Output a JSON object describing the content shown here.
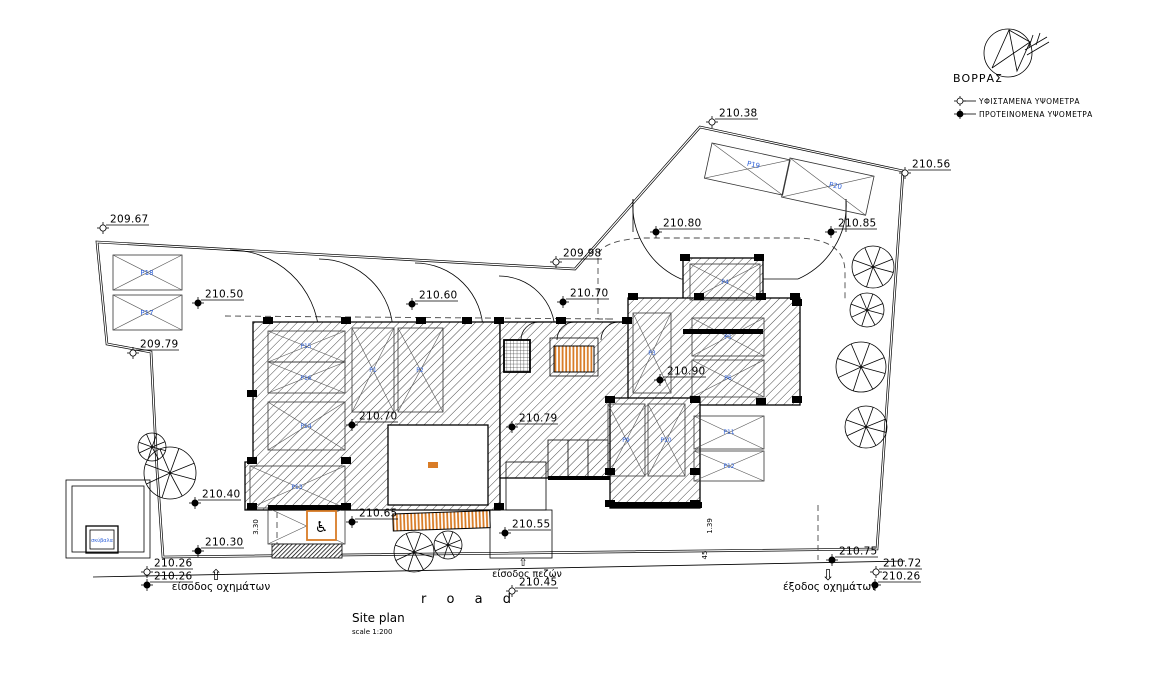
{
  "drawing": {
    "title": "Site plan",
    "scale": "scale 1:200",
    "road_label": "r o a d",
    "compass_label": "ΒΟΡΡΑΣ",
    "legend": {
      "existing_label": "ΥΦΙΣΤΑΜΕΝΑ ΥΨΟΜΕΤΡΑ",
      "proposed_label": "ΠΡΟΤΕΙΝΟΜΕΝΑ ΥΨΟΜΕΤΡΑ"
    },
    "entrances": {
      "vehicle_entrance": "είσοδος οχημάτων",
      "pedestrian_entrance": "είσοδος πεζών",
      "vehicle_exit": "έξοδος οχημάτων"
    },
    "waste_box_label": "σκύβαλα",
    "accessible_parking_symbol": "♿",
    "arrows": {
      "up": "⇧",
      "down": "⇩"
    },
    "elevation_markers": [
      {
        "value": "209.67",
        "type": "existing",
        "x": 103,
        "y": 228
      },
      {
        "value": "210.38",
        "type": "existing",
        "x": 712,
        "y": 122
      },
      {
        "value": "210.56",
        "type": "existing",
        "x": 905,
        "y": 173
      },
      {
        "value": "209.98",
        "type": "existing",
        "x": 556,
        "y": 262
      },
      {
        "value": "209.79",
        "type": "existing",
        "x": 133,
        "y": 353
      },
      {
        "value": "210.50",
        "type": "proposed",
        "x": 198,
        "y": 303
      },
      {
        "value": "210.60",
        "type": "proposed",
        "x": 412,
        "y": 304
      },
      {
        "value": "210.70",
        "type": "proposed",
        "x": 563,
        "y": 302
      },
      {
        "value": "210.80",
        "type": "proposed",
        "x": 656,
        "y": 232
      },
      {
        "value": "210.85",
        "type": "proposed",
        "x": 831,
        "y": 232
      },
      {
        "value": "210.70",
        "type": "proposed",
        "x": 352,
        "y": 425
      },
      {
        "value": "210.79",
        "type": "proposed",
        "x": 512,
        "y": 427
      },
      {
        "value": "210.90",
        "type": "proposed",
        "x": 660,
        "y": 380
      },
      {
        "value": "210.40",
        "type": "proposed",
        "x": 195,
        "y": 503
      },
      {
        "value": "210.65",
        "type": "proposed",
        "x": 352,
        "y": 522
      },
      {
        "value": "210.55",
        "type": "proposed",
        "x": 505,
        "y": 533
      },
      {
        "value": "210.30",
        "type": "proposed",
        "x": 198,
        "y": 551
      },
      {
        "value": "210.26",
        "type": "existing",
        "x": 147,
        "y": 572
      },
      {
        "value": "210.26",
        "type": "proposed",
        "x": 147,
        "y": 585
      },
      {
        "value": "210.45",
        "type": "existing",
        "x": 512,
        "y": 591
      },
      {
        "value": "210.75",
        "type": "proposed",
        "x": 832,
        "y": 560
      },
      {
        "value": "210.72",
        "type": "existing",
        "x": 876,
        "y": 572
      },
      {
        "value": "210.26",
        "type": "proposed",
        "x": 875,
        "y": 585
      }
    ],
    "parking_labels": [
      {
        "label": "P18",
        "x": 147,
        "y": 275,
        "size": 7,
        "rot": 0
      },
      {
        "label": "P17",
        "x": 147,
        "y": 315,
        "size": 7,
        "rot": 0
      },
      {
        "label": "P19",
        "x": 753,
        "y": 167,
        "size": 7,
        "rot": 12
      },
      {
        "label": "P20",
        "x": 835,
        "y": 188,
        "size": 7,
        "rot": 12
      },
      {
        "label": "P15",
        "x": 306,
        "y": 348,
        "size": 6,
        "rot": 0
      },
      {
        "label": "P16",
        "x": 306,
        "y": 380,
        "size": 6,
        "rot": 0
      },
      {
        "label": "P14",
        "x": 306,
        "y": 428,
        "size": 6,
        "rot": 0
      },
      {
        "label": "P13",
        "x": 297,
        "y": 489,
        "size": 6,
        "rot": 0
      },
      {
        "label": "P1",
        "x": 373,
        "y": 372,
        "size": 6,
        "rot": 0
      },
      {
        "label": "P2",
        "x": 420,
        "y": 372,
        "size": 6,
        "rot": 0
      },
      {
        "label": "P3",
        "x": 652,
        "y": 355,
        "size": 6,
        "rot": 0
      },
      {
        "label": "P4",
        "x": 725,
        "y": 284,
        "size": 6,
        "rot": 0
      },
      {
        "label": "P5",
        "x": 728,
        "y": 339,
        "size": 6,
        "rot": 0
      },
      {
        "label": "P6",
        "x": 728,
        "y": 380,
        "size": 6,
        "rot": 0
      },
      {
        "label": "P9",
        "x": 626,
        "y": 442,
        "size": 6,
        "rot": 0
      },
      {
        "label": "P10",
        "x": 666,
        "y": 442,
        "size": 6,
        "rot": 0
      },
      {
        "label": "P11",
        "x": 729,
        "y": 434,
        "size": 6,
        "rot": 0
      },
      {
        "label": "P12",
        "x": 729,
        "y": 468,
        "size": 6,
        "rot": 0
      }
    ],
    "dimension_labels": [
      {
        "value": "3.30",
        "x": 258,
        "y": 527
      },
      {
        "value": "1.39",
        "x": 712,
        "y": 526
      },
      {
        "value": "45",
        "x": 707,
        "y": 555
      }
    ],
    "colors": {
      "line": "#000000",
      "parking_label_blue": "#2b5fd9",
      "accent_orange": "#d97c26",
      "hatch_gray": "#4a4a4a"
    }
  }
}
